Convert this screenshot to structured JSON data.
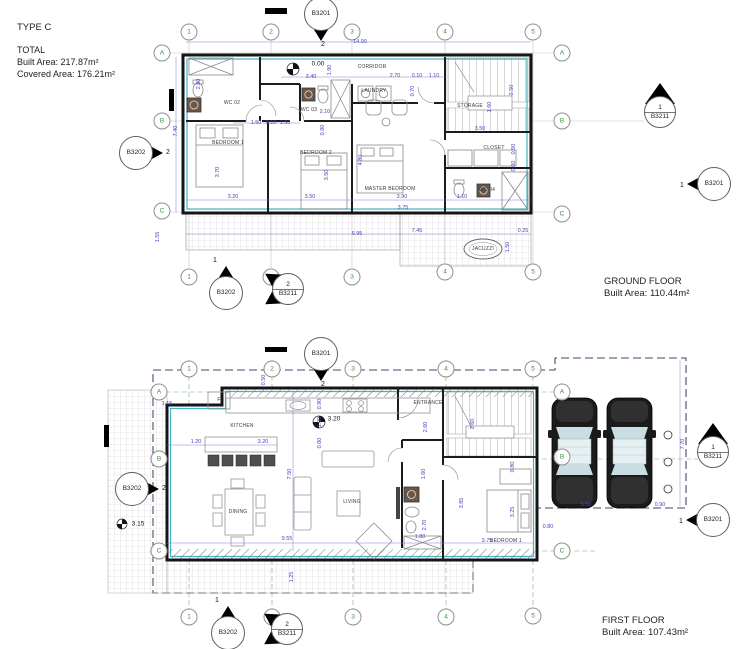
{
  "header": {
    "type": "TYPE C",
    "total": "TOTAL",
    "built": "Built Area: 217.87m²",
    "covered": "Covered Area: 176.21m²"
  },
  "colors": {
    "wall": "#151515",
    "insulation_teal": "#3fb5c2",
    "dimension_blue": "#4646c0",
    "grid_green": "#3f8f3f",
    "boundary_dash": "#45456e"
  },
  "ground_floor": {
    "title": "GROUND FLOOR",
    "built_area": "Built Area: 110.44m²",
    "grid_bubbles": [
      {
        "t": "1",
        "x": 189,
        "y": 32
      },
      {
        "t": "2",
        "x": 271,
        "y": 32
      },
      {
        "t": "3",
        "x": 352,
        "y": 32
      },
      {
        "t": "4",
        "x": 445,
        "y": 32
      },
      {
        "t": "5",
        "x": 533,
        "y": 32
      },
      {
        "t": "1",
        "x": 189,
        "y": 277
      },
      {
        "t": "2",
        "x": 271,
        "y": 277
      },
      {
        "t": "3",
        "x": 352,
        "y": 277
      },
      {
        "t": "4",
        "x": 445,
        "y": 272
      },
      {
        "t": "5",
        "x": 533,
        "y": 272
      },
      {
        "t": "A",
        "x": 162,
        "y": 53
      },
      {
        "t": "B",
        "x": 162,
        "y": 121
      },
      {
        "t": "C",
        "x": 162,
        "y": 211
      },
      {
        "t": "A",
        "x": 562,
        "y": 53
      },
      {
        "t": "B",
        "x": 562,
        "y": 121
      },
      {
        "t": "C",
        "x": 562,
        "y": 214
      }
    ],
    "dimensions": [
      {
        "t": "14.90",
        "x": 360,
        "y": 42,
        "r": 0
      },
      {
        "t": "3.40",
        "x": 311,
        "y": 77,
        "r": 0
      },
      {
        "t": "1.90",
        "x": 330,
        "y": 70,
        "r": -90
      },
      {
        "t": "2.70",
        "x": 395,
        "y": 76,
        "r": 0
      },
      {
        "t": "0.10",
        "x": 417,
        "y": 76,
        "r": 0
      },
      {
        "t": "1.10",
        "x": 434,
        "y": 76,
        "r": 0
      },
      {
        "t": "0.70",
        "x": 413,
        "y": 91,
        "r": -90
      },
      {
        "t": "2.50",
        "x": 512,
        "y": 90,
        "r": -90
      },
      {
        "t": "1.60",
        "x": 490,
        "y": 107,
        "r": -90
      },
      {
        "t": "2.30",
        "x": 199,
        "y": 84,
        "r": -90
      },
      {
        "t": "2.10",
        "x": 325,
        "y": 112,
        "r": 0
      },
      {
        "t": "1.50",
        "x": 256,
        "y": 123,
        "r": 0
      },
      {
        "t": "0.10",
        "x": 271,
        "y": 123,
        "r": 0
      },
      {
        "t": "1.50",
        "x": 285,
        "y": 123,
        "r": 0
      },
      {
        "t": "0.80",
        "x": 323,
        "y": 130,
        "r": -90
      },
      {
        "t": "7.40",
        "x": 176,
        "y": 131,
        "r": -90
      },
      {
        "t": "3.70",
        "x": 218,
        "y": 172,
        "r": -90
      },
      {
        "t": "3.50",
        "x": 327,
        "y": 175,
        "r": -90
      },
      {
        "t": "4.80",
        "x": 361,
        "y": 160,
        "r": -90
      },
      {
        "t": "3.20",
        "x": 233,
        "y": 197,
        "r": 0
      },
      {
        "t": "3.50",
        "x": 310,
        "y": 197,
        "r": 0
      },
      {
        "t": "3.90",
        "x": 402,
        "y": 197,
        "r": 0
      },
      {
        "t": "3.75",
        "x": 403,
        "y": 208,
        "r": 0
      },
      {
        "t": "1.10",
        "x": 462,
        "y": 197,
        "r": 0
      },
      {
        "t": "0.50",
        "x": 514,
        "y": 149,
        "r": -90
      },
      {
        "t": "0.60",
        "x": 514,
        "y": 166,
        "r": -90
      },
      {
        "t": "3.50",
        "x": 480,
        "y": 129,
        "r": 0
      },
      {
        "t": "6.95",
        "x": 357,
        "y": 234,
        "r": 0
      },
      {
        "t": "7.45",
        "x": 417,
        "y": 231,
        "r": 0
      },
      {
        "t": "0.25",
        "x": 523,
        "y": 231,
        "r": 0
      },
      {
        "t": "1.55",
        "x": 158,
        "y": 237,
        "r": -90
      },
      {
        "t": "1.50",
        "x": 508,
        "y": 247,
        "r": -90
      }
    ],
    "room_labels": [
      {
        "t": "CORRIDOR",
        "x": 372,
        "y": 67
      },
      {
        "t": "LAUNDRY",
        "x": 374,
        "y": 91
      },
      {
        "t": "STORAGE",
        "x": 470,
        "y": 106
      },
      {
        "t": "WC 02",
        "x": 232,
        "y": 103
      },
      {
        "t": "WC 03",
        "x": 309,
        "y": 110
      },
      {
        "t": "BEDROOM 1",
        "x": 228,
        "y": 143
      },
      {
        "t": "BEDROOM 2",
        "x": 316,
        "y": 153
      },
      {
        "t": "MASTER BEDROOM",
        "x": 390,
        "y": 189
      },
      {
        "t": "CLOSET",
        "x": 494,
        "y": 148
      },
      {
        "t": "WC 04",
        "x": 487,
        "y": 190
      },
      {
        "t": "JACUZZI",
        "x": 483,
        "y": 249
      }
    ],
    "levels": [
      {
        "t": "0.00",
        "x": 318,
        "y": 64
      }
    ],
    "callouts": [
      {
        "label": "B3201",
        "num": "2",
        "type": "down",
        "x": 321,
        "y": 14
      },
      {
        "label": "B3202",
        "num": "2",
        "type": "right",
        "x": 136,
        "y": 153
      },
      {
        "label": "B3211",
        "num": "1",
        "type": "split-up",
        "x": 660,
        "y": 112
      },
      {
        "label": "B3201",
        "num": "1",
        "type": "left",
        "x": 714,
        "y": 184
      },
      {
        "label": "B3202",
        "num": "1",
        "type": "up",
        "x": 226,
        "y": 293
      },
      {
        "label": "B3211",
        "num": "2",
        "type": "split-left",
        "x": 288,
        "y": 289
      }
    ]
  },
  "first_floor": {
    "title": "FIRST FLOOR",
    "built_area": "Built Area: 107.43m²",
    "grid_bubbles": [
      {
        "t": "1",
        "x": 189,
        "y": 369
      },
      {
        "t": "2",
        "x": 272,
        "y": 369
      },
      {
        "t": "3",
        "x": 353,
        "y": 369
      },
      {
        "t": "4",
        "x": 446,
        "y": 369
      },
      {
        "t": "5",
        "x": 533,
        "y": 369
      },
      {
        "t": "1",
        "x": 189,
        "y": 617
      },
      {
        "t": "2",
        "x": 272,
        "y": 617
      },
      {
        "t": "3",
        "x": 353,
        "y": 617
      },
      {
        "t": "4",
        "x": 446,
        "y": 617
      },
      {
        "t": "5",
        "x": 533,
        "y": 616
      },
      {
        "t": "A",
        "x": 159,
        "y": 392
      },
      {
        "t": "B",
        "x": 159,
        "y": 459
      },
      {
        "t": "C",
        "x": 159,
        "y": 551
      },
      {
        "t": "A",
        "x": 562,
        "y": 392
      },
      {
        "t": "B",
        "x": 562,
        "y": 457
      },
      {
        "t": "C",
        "x": 562,
        "y": 551
      }
    ],
    "dimensions": [
      {
        "t": "0.50",
        "x": 264,
        "y": 380,
        "r": -90
      },
      {
        "t": "1.15",
        "x": 167,
        "y": 404,
        "r": 0
      },
      {
        "t": "1.20",
        "x": 196,
        "y": 442,
        "r": 0
      },
      {
        "t": "3.20",
        "x": 263,
        "y": 442,
        "r": 0
      },
      {
        "t": "0.90",
        "x": 320,
        "y": 404,
        "r": -90
      },
      {
        "t": "1.00",
        "x": 320,
        "y": 422,
        "r": -90
      },
      {
        "t": "0.60",
        "x": 320,
        "y": 443,
        "r": -90
      },
      {
        "t": "2.60",
        "x": 426,
        "y": 427,
        "r": -90
      },
      {
        "t": "2.60",
        "x": 473,
        "y": 424,
        "r": -90
      },
      {
        "t": "1.60",
        "x": 424,
        "y": 474,
        "r": -90
      },
      {
        "t": "0.80",
        "x": 513,
        "y": 467,
        "r": -90
      },
      {
        "t": "7.50",
        "x": 290,
        "y": 474,
        "r": -90
      },
      {
        "t": "9.55",
        "x": 287,
        "y": 539,
        "r": 0
      },
      {
        "t": "1.25",
        "x": 292,
        "y": 577,
        "r": -90
      },
      {
        "t": "2.70",
        "x": 425,
        "y": 525,
        "r": -90
      },
      {
        "t": "1.80",
        "x": 420,
        "y": 537,
        "r": 0
      },
      {
        "t": "3.85",
        "x": 462,
        "y": 503,
        "r": -90
      },
      {
        "t": "3.25",
        "x": 513,
        "y": 512,
        "r": -90
      },
      {
        "t": "3.75",
        "x": 487,
        "y": 541,
        "r": 0
      },
      {
        "t": "5.50",
        "x": 586,
        "y": 505,
        "r": 0
      },
      {
        "t": "0.90",
        "x": 660,
        "y": 505,
        "r": 0
      },
      {
        "t": "0.80",
        "x": 548,
        "y": 527,
        "r": 0
      },
      {
        "t": "7.70",
        "x": 683,
        "y": 444,
        "r": -90
      }
    ],
    "room_labels": [
      {
        "t": "KITCHEN",
        "x": 242,
        "y": 426
      },
      {
        "t": "F",
        "x": 219,
        "y": 400
      },
      {
        "t": "DINING",
        "x": 238,
        "y": 512
      },
      {
        "t": "LIVING",
        "x": 352,
        "y": 502
      },
      {
        "t": "ENTRANCE",
        "x": 428,
        "y": 403
      },
      {
        "t": "BEDROOM 1",
        "x": 506,
        "y": 541
      }
    ],
    "levels": [
      {
        "t": "3.20",
        "x": 334,
        "y": 419
      },
      {
        "t": "3.15",
        "x": 138,
        "y": 524
      }
    ],
    "callouts": [
      {
        "label": "B3201",
        "num": "2",
        "type": "down",
        "x": 321,
        "y": 354
      },
      {
        "label": "B3202",
        "num": "2",
        "type": "right",
        "x": 132,
        "y": 489
      },
      {
        "label": "B3211",
        "num": "1",
        "type": "split-up",
        "x": 713,
        "y": 452
      },
      {
        "label": "B3201",
        "num": "1",
        "type": "left",
        "x": 713,
        "y": 520
      },
      {
        "label": "B3202",
        "num": "1",
        "type": "up",
        "x": 228,
        "y": 633
      },
      {
        "label": "B3211",
        "num": "2",
        "type": "split-left",
        "x": 287,
        "y": 629
      }
    ]
  }
}
